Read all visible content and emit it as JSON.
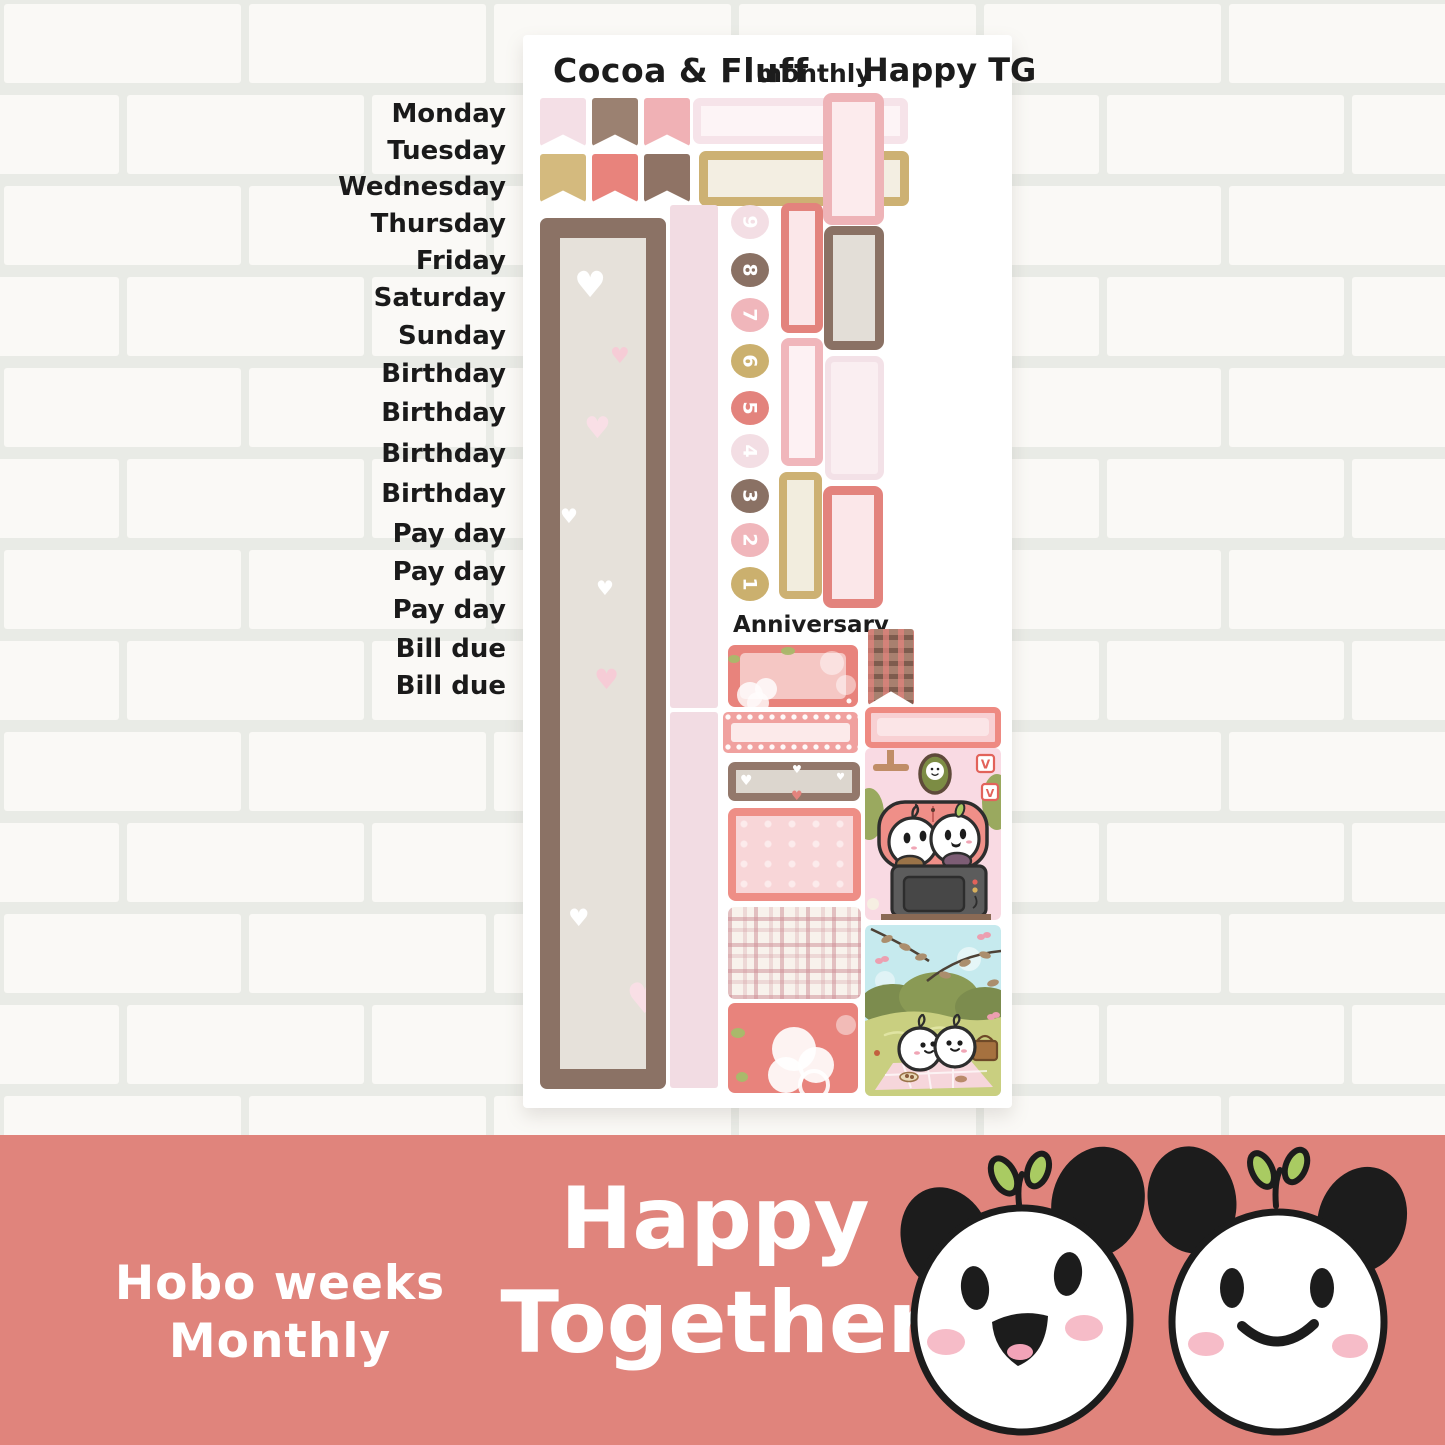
{
  "sheet": {
    "brand": "Cocoa & Fluff",
    "kit_type": "monthly",
    "theme_name": "Happy TG",
    "day_labels": [
      "Monday",
      "Tuesday",
      "Wednesday",
      "Thursday",
      "Friday",
      "Saturday",
      "Sunday",
      "Birthday",
      "Birthday",
      "Birthday",
      "Birthday",
      "Pay day",
      "Pay day",
      "Pay day",
      "Bill due",
      "Bill due"
    ],
    "anniversary_label": "Anniversary",
    "date_dots": [
      {
        "label": "9",
        "color": "#f3dee4"
      },
      {
        "label": "8",
        "color": "#8a7164"
      },
      {
        "label": "7",
        "color": "#f0b6bb"
      },
      {
        "label": "6",
        "color": "#cbb06e"
      },
      {
        "label": "5",
        "color": "#e3837d"
      },
      {
        "label": "4",
        "color": "#f3dee4"
      },
      {
        "label": "3",
        "color": "#8a7164"
      },
      {
        "label": "2",
        "color": "#f0b6bb"
      },
      {
        "label": "1",
        "color": "#cbb06e"
      }
    ],
    "flag_colors_row1": [
      "#f4dfe6",
      "#9b8171",
      "#f0b1b5"
    ],
    "flag_colors_row2": [
      "#d4ba7e",
      "#e8837c",
      "#8f7365"
    ],
    "tv_blocks": [
      "V",
      "V"
    ]
  },
  "banner": {
    "kit_line1": "Hobo weeks",
    "kit_line2": "Monthly",
    "theme_line1": "Happy",
    "theme_line2": "Together",
    "bg_color": "#e0847c",
    "text_color": "#ffffff"
  },
  "palette": {
    "coral": "#e3837d",
    "pink": "#f0b6bb",
    "light_pink": "#f3dee4",
    "gold": "#cdb173",
    "brown": "#8b7265",
    "greige": "#e6e1da",
    "cream": "#f2edde",
    "wall_tile": "#faf9f6",
    "wall_grout": "#e9ebe6"
  }
}
